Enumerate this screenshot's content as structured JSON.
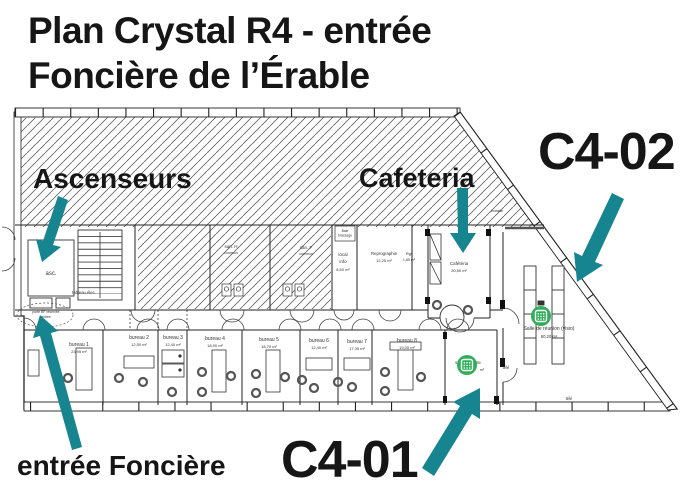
{
  "title": {
    "line1": "Plan Crystal R4 - entrée",
    "line2": "Foncière de l’Érable"
  },
  "annotations": {
    "ascenseurs": "Ascenseurs",
    "cafeteria": "Cafeteria",
    "c4_02": "C4-02",
    "c4_01": "C4-01",
    "entree_fonciere": "entrée Foncière"
  },
  "colors": {
    "arrow_teal": "#17858F",
    "marker_green": "#2FAF58",
    "ink": "#161616"
  },
  "plan": {
    "small_labels": {
      "asc": "asc.",
      "tableau_elec": "tableau élec.",
      "san_h": "san. H",
      "san_h_note": "commun",
      "san_f": "san. F",
      "san_f_note": "commun",
      "baie_1": "Baie",
      "baie_2": "brassage",
      "local_1": "local",
      "local_2": "info",
      "local_area": "8,50 m²",
      "repro": "Reprographie",
      "repro_area": "12,25 m²",
      "rgt": "Rgt",
      "rgt_area": "1,85 m²",
      "cafeteria": "Cafétéria",
      "cafeteria_area": "20,50 m²",
      "reunion": "Salle de réunion (visio)",
      "reunion_area": "60,20 m²",
      "attente": "salle d'attente",
      "attente_area": "m²",
      "porte_1": "porte BF réservée",
      "porte_2": "entrée",
      "tele_1": "télé",
      "tele_2": "télé",
      "estrade": "estrade"
    },
    "bureaus": [
      {
        "name": "bureau 1",
        "area": "23,95 m²"
      },
      {
        "name": "bureau 2",
        "area": "12,50 m²"
      },
      {
        "name": "bureau 3",
        "area": "12,40 m²"
      },
      {
        "name": "bureau 4",
        "area": "18,90 m²"
      },
      {
        "name": "bureau 5",
        "area": "18,70 m²"
      },
      {
        "name": "bureau 6",
        "area": "12,40 m²"
      },
      {
        "name": "bureau 7",
        "area": "17,35 m²"
      },
      {
        "name": "bureau 8",
        "area": "19,05 m²"
      }
    ]
  }
}
